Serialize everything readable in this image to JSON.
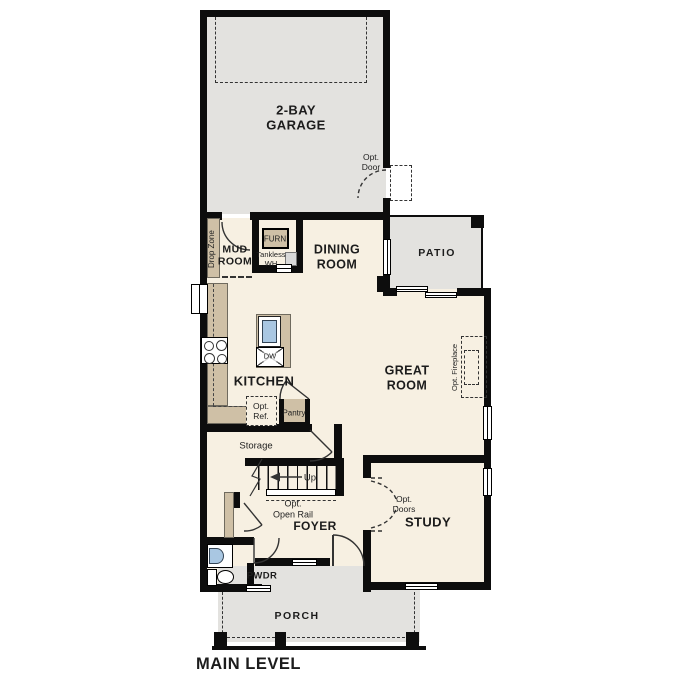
{
  "title": "MAIN LEVEL",
  "colors": {
    "floor": "#f7f0e2",
    "hardscape_gray": "#e3e2df",
    "counter_tan": "#cfc0a6",
    "fixture_blue": "#a9c7e2",
    "wall_black": "#0d0d0d"
  },
  "rooms": {
    "garage": {
      "label": "2-BAY\nGARAGE"
    },
    "mud_room": {
      "label": "MUD\nROOM"
    },
    "dining": {
      "label": "DINING\nROOM"
    },
    "patio": {
      "label": "PATIO"
    },
    "kitchen": {
      "label": "KITCHEN"
    },
    "great_room": {
      "label": "GREAT\nROOM"
    },
    "foyer": {
      "label": "FOYER"
    },
    "study": {
      "label": "STUDY"
    },
    "pwdr": {
      "label": "PWDR"
    },
    "porch": {
      "label": "PORCH"
    },
    "storage": {
      "label": "Storage"
    }
  },
  "annotations": {
    "opt_door": "Opt.\nDoor",
    "drop_zone": "Drop Zone",
    "furn": "FURN",
    "tankless_wh": "Tankless\nWH",
    "dw": "DW",
    "opt_ref": "Opt.\nRef.",
    "pantry": "Pantry",
    "up": "Up",
    "opt_open_rail": "Opt.\nOpen Rail",
    "opt_fireplace": "Opt. Fireplace",
    "opt_doors": "Opt.\nDoors"
  }
}
